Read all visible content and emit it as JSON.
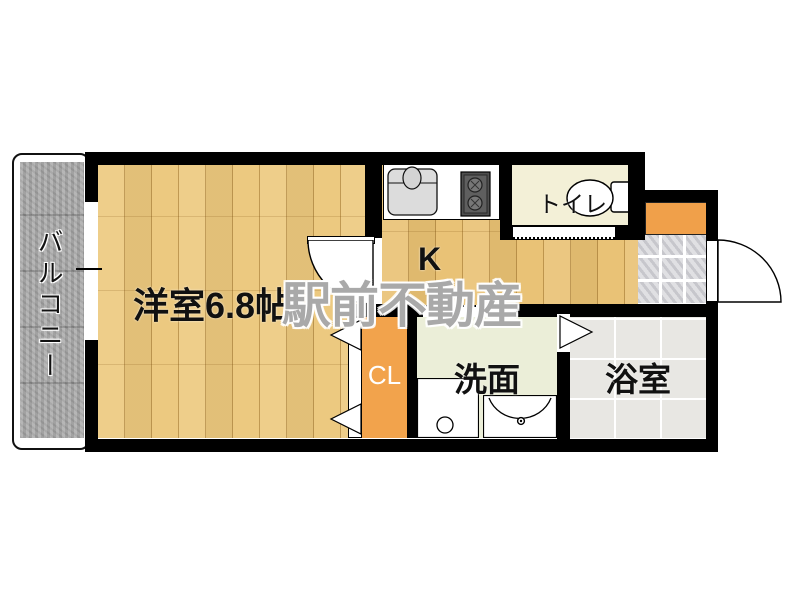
{
  "plan_type": "apartment-floor-plan",
  "rooms": {
    "balcony": {
      "label": "バルコニー"
    },
    "western_room": {
      "label": "洋室6.8帖"
    },
    "kitchen": {
      "label": "K"
    },
    "toilet": {
      "label": "トイレ"
    },
    "closet": {
      "label": "CL"
    },
    "washroom": {
      "label": "洗面"
    },
    "bathroom": {
      "label": "浴室"
    }
  },
  "watermark": {
    "text": "駅前不動産"
  },
  "colors": {
    "wall": "#000000",
    "wood_floor": "#ecc87d",
    "kitchen_floor": "#e9c173",
    "closet_orange": "#f2a34c",
    "shoe_cabinet_orange": "#f0a04a",
    "balcony_concrete": "#a9a9a9",
    "toilet_floor": "#f3f0d7",
    "washroom_floor": "#ebeed8",
    "bathroom_floor": "#e8e7e3",
    "entrance_tile": "#d8d8dc",
    "watermark_gray": "#707070"
  },
  "fixtures": {
    "kitchen_sink": "sink-with-faucet",
    "stove": "two-burner-stove",
    "toilet_bowl": "toilet-with-tank",
    "washing_machine": "washing-machine-pan",
    "washbasin": "wash-basin",
    "window": "sliding-window",
    "entry_door": "swing-door",
    "room_door": "swing-door",
    "closet_door": "folding-door",
    "bath_door": "folding-door"
  }
}
